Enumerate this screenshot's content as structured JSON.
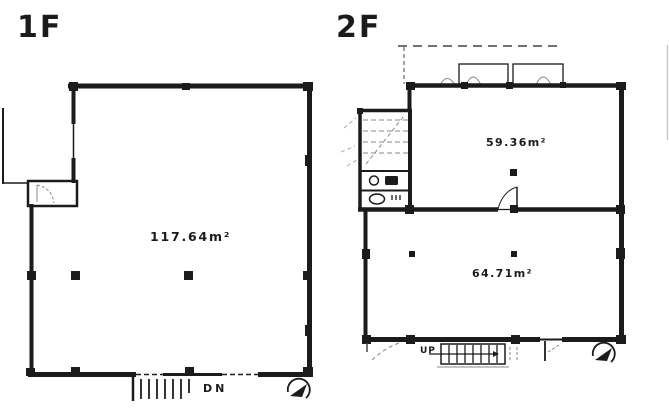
{
  "colors": {
    "background": "#ffffff",
    "line": "#1b1b1b",
    "faint_line": "#888888"
  },
  "floor_1f": {
    "title": "1F",
    "area": "117.64m²",
    "stair_label": "DN"
  },
  "floor_2f": {
    "title": "2F",
    "upper_room_area": "59.36m²",
    "lower_room_area": "64.71m²",
    "stair_label": "UP"
  },
  "icons": {
    "compass_1f": "north-arrow-icon",
    "compass_2f": "north-arrow-icon",
    "sink": "sink-icon",
    "toilet": "toilet-icon"
  }
}
